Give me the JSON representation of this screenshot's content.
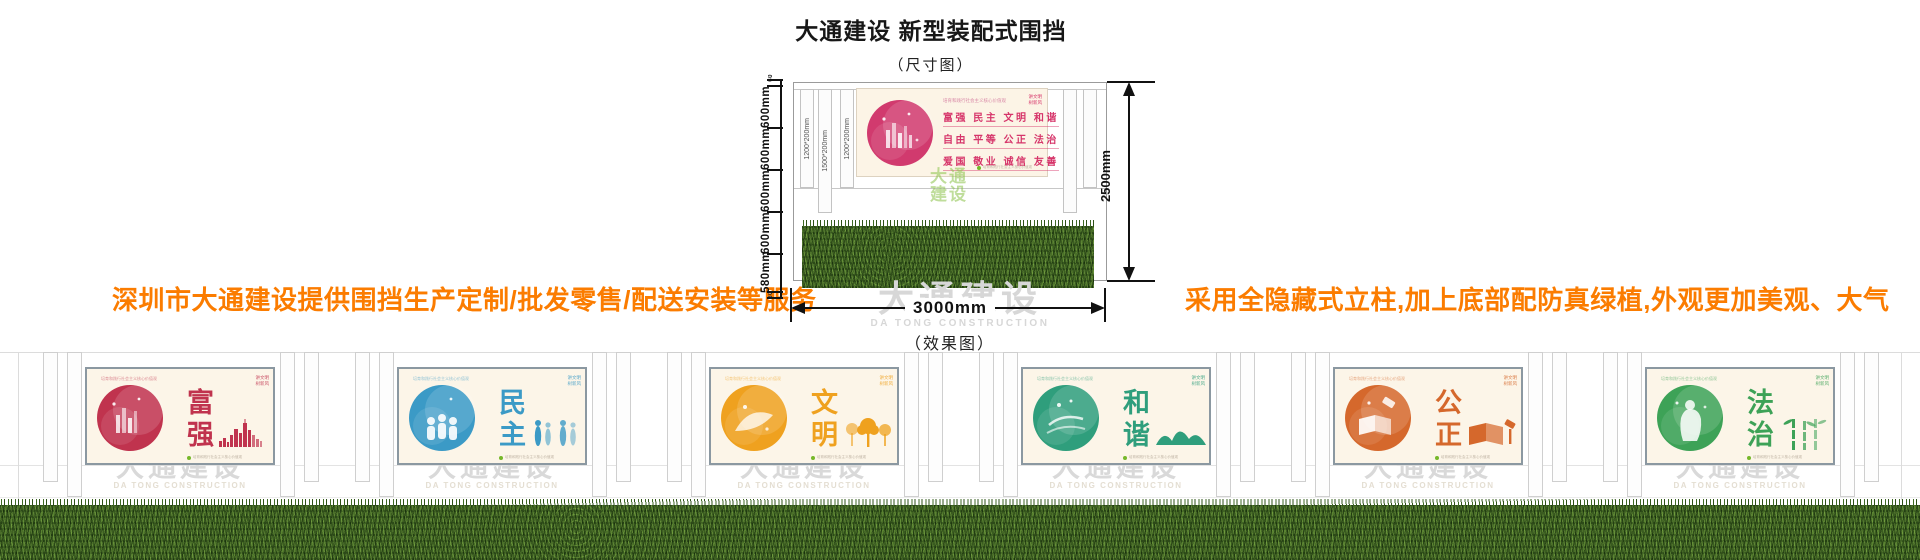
{
  "header": {
    "title": "大通建设 新型装配式围挡",
    "subtitle": "（尺寸图）"
  },
  "notes": {
    "left": "深圳市大通建设提供围挡生产定制/批发零售/配送安装等服务",
    "right": "采用全隐藏式立柱,加上底部配防真绿植,外观更加美观、大气",
    "color": "#fb7c00"
  },
  "diagram": {
    "ruler": [
      "60",
      "600mm",
      "600mm",
      "600mm",
      "600mm",
      "580mm",
      "80"
    ],
    "posts": [
      "1200*200mm",
      "1500*200mm",
      "1200*200mm"
    ],
    "height_label": "2500mm",
    "width_label": "3000mm",
    "caption_effect": "（效果图）",
    "billboard": {
      "header_line": "培育和践行社会主义核心价值观",
      "corner": [
        "讲文明",
        "树新风"
      ],
      "rows": [
        "富强  民主  文明  和谐",
        "自由  平等  公正  法治",
        "爱国  敬业  诚信  友善"
      ],
      "accent": "#d6356a"
    },
    "green_watermark": [
      "大通",
      "建设"
    ]
  },
  "watermark": {
    "cn": "大通建设",
    "en": "DA TONG CONSTRUCTION"
  },
  "panels_common": {
    "header_line": "培育和践行社会主义核心价值观",
    "corner": [
      "讲文明",
      "树新风"
    ],
    "small_print": "培育和践行社会主义核心价值观",
    "dot_color": "#76b82a"
  },
  "panels": [
    {
      "word": "富强",
      "color": "#c0334e",
      "light": "#eba4b4",
      "motif": "city-skyline"
    },
    {
      "word": "民主",
      "color": "#3b9ac6",
      "light": "#a8d4ea",
      "motif": "people-figures"
    },
    {
      "word": "文明",
      "color": "#efa11f",
      "light": "#f8d79d",
      "motif": "trees"
    },
    {
      "word": "和谐",
      "color": "#2f9e7c",
      "light": "#a5d6c3",
      "motif": "mountains"
    },
    {
      "word": "公正",
      "color": "#d5682c",
      "light": "#f0bd9a",
      "motif": "book-gavel"
    },
    {
      "word": "法治",
      "color": "#3da257",
      "light": "#a9d9b4",
      "motif": "bamboo"
    }
  ]
}
